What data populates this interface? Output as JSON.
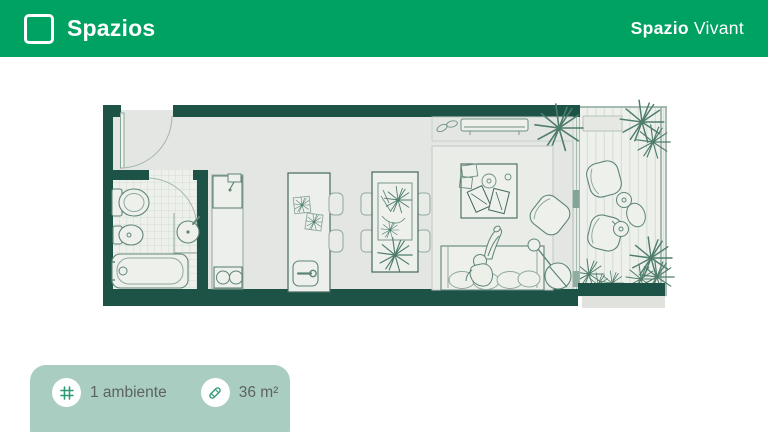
{
  "header": {
    "brand": "Spazios",
    "project_name_bold": "Spazio",
    "project_name_light": "Vivant",
    "background_color": "#00a261",
    "logo_icon": "square-outline-logo"
  },
  "floor_plan": {
    "unit_name": "Spazio Vivant",
    "wall_color": "#1d5247",
    "floor_color": "#e4e6e3",
    "line_color": "#5f8578",
    "rooms": [
      {
        "name": "entry",
        "fixtures": [
          "entry-door"
        ]
      },
      {
        "name": "bathroom",
        "fixtures": [
          "toilet",
          "bidet",
          "bathtub",
          "vanity-sink",
          "tiled-floor",
          "bathroom-door"
        ]
      },
      {
        "name": "kitchen",
        "fixtures": [
          "sink-counter",
          "two-burner-cooktop",
          "kitchen-island",
          "island-sink",
          "bar-stools"
        ]
      },
      {
        "name": "living-dining",
        "fixtures": [
          "dining-table",
          "dining-chairs",
          "rug",
          "coffee-table",
          "books",
          "sofa",
          "person-on-sofa",
          "lounge-chair",
          "floor-lamp",
          "air-conditioner",
          "slippers",
          "corner-plant"
        ]
      },
      {
        "name": "balcony",
        "fixtures": [
          "wood-deck",
          "planter-box",
          "lounge-chair-1",
          "lounge-chair-2",
          "side-table-with-cups",
          "corner-plants",
          "railing",
          "sliding-glass-door"
        ]
      }
    ]
  },
  "info_badge": {
    "background_color": "#a9cdc0",
    "items": [
      {
        "icon": "grid-icon",
        "label": "1 ambiente"
      },
      {
        "icon": "ruler-icon",
        "label": "36 m²"
      }
    ]
  }
}
